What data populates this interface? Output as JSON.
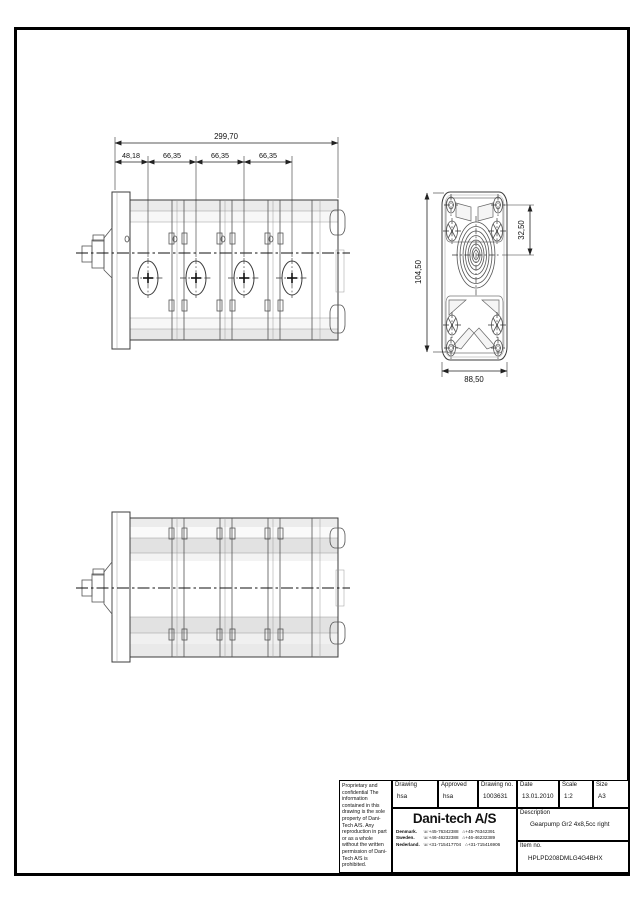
{
  "sheet": {
    "dimensions": {
      "side_total": "299,70",
      "seg1": "48,18",
      "seg2": "66,35",
      "seg3": "66,35",
      "seg4": "66,35",
      "end_height": "104,50",
      "end_offset": "32,50",
      "end_width": "88,50"
    },
    "icons": {
      "phone": "☏",
      "fax": "⌂"
    },
    "title_block": {
      "proprietary": "Proprietary and confidential The information contained in this drawing is the sole property of Dani-Tech A/S. Any reproduction in part or as a whole without the written permission of Dani-Tech A/S is prohibited.",
      "drawing_label": "Drawing",
      "drawing_value": "hsa",
      "approved_label": "Approved",
      "approved_value": "hsa",
      "drawing_no_label": "Drawing no.",
      "drawing_no_value": "1003631",
      "date_label": "Date",
      "date_value": "13.01.2010",
      "scale_label": "Scale",
      "scale_value": "1:2",
      "size_label": "Size",
      "size_value": "A3",
      "company": "Dani-tech A/S",
      "contacts": [
        {
          "country": "Denmark.",
          "phone": "+45-76342388",
          "fax": "+45-76342391"
        },
        {
          "country": "Sweden.",
          "phone": "+46-46232388",
          "fax": "+46-46232389"
        },
        {
          "country": "Nederland.",
          "phone": "+31-715417704",
          "fax": "+31-715416906"
        }
      ],
      "description_label": "Description",
      "description_value": "Gearpump Gr2 4x8,5cc right",
      "item_label": "Item no.",
      "item_value": "HPLPD208DMLG4G4BHX"
    }
  }
}
